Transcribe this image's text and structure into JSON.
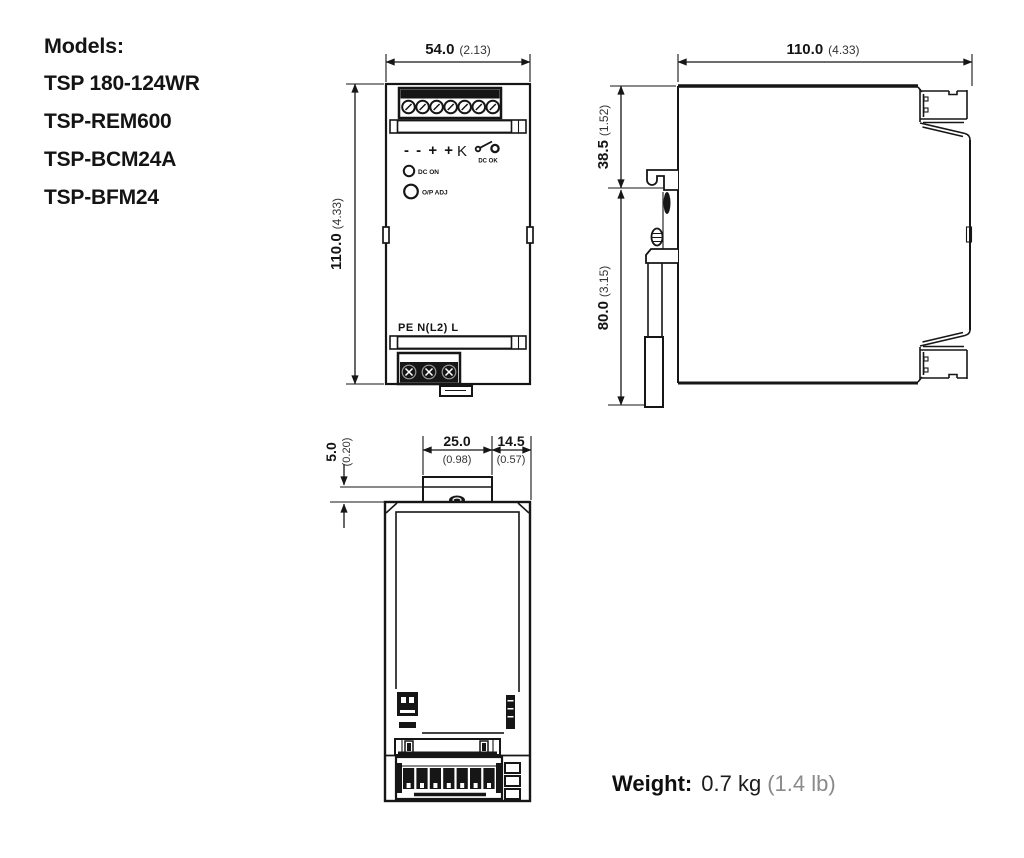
{
  "models": {
    "heading": "Models:",
    "items": [
      "TSP 180-124WR",
      "TSP-REM600",
      "TSP-BCM24A",
      "TSP-BFM24"
    ]
  },
  "front_view": {
    "width_mm": "54.0",
    "width_in": "(2.13)",
    "height_mm": "110.0",
    "height_in": "(4.33)",
    "polarity_symbols": "- - + +",
    "relay_symbol": "K",
    "dc_ok_label": "DC OK",
    "dc_on_label": "DC ON",
    "output_adjust_label": "O/P ADJ",
    "input_terminal_labels": "PE N(L2) L"
  },
  "side_view": {
    "depth_mm": "110.0",
    "depth_in": "(4.33)",
    "upper_mm": "38.5",
    "upper_in": "(1.52)",
    "lower_mm": "80.0",
    "lower_in": "(3.15)"
  },
  "top_view": {
    "clip_mm": "25.0",
    "clip_in": "(0.98)",
    "offset_mm": "14.5",
    "offset_in": "(0.57)",
    "depth_mm": "5.0",
    "depth_in": "(0.20)"
  },
  "weight": {
    "label": "Weight:",
    "metric": "0.7 kg",
    "imperial": "(1.4 lb)"
  },
  "colors": {
    "line": "#161616",
    "background": "#ffffff",
    "muted_text": "#8a8a8a"
  }
}
